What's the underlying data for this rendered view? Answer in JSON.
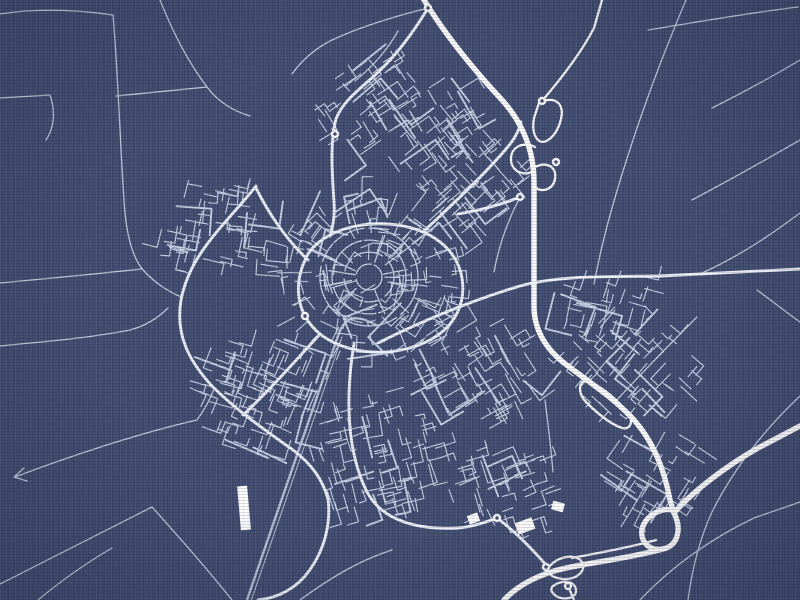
{
  "poster": {
    "width": 800,
    "height": 600,
    "seed": 12,
    "background_color": "#414c70",
    "road_thin_color": "#d3dcee",
    "road_medium_color": "#eef2fa",
    "road_major_color": "#ffffff",
    "railway_color": "#c6cfe2",
    "motorways": [
      "M 424,0 C 446,36 474,70 502,100 C 522,122 534,150 534,182 L 534,306 C 534,330 546,350 568,366 C 592,384 616,400 634,420 C 652,440 664,468 670,500 L 674,513",
      "M 674,513 C 692,492 726,466 758,448 L 800,426",
      "M 674,513 C 682,529 678,546 663,549 C 648,552 638,539 643,526 C 648,514 662,508 672,510",
      "M 663,549 C 630,558 594,562 566,568 C 538,574 517,586 504,600"
    ],
    "ramps": [
      "M 539,103 C 554,95 565,103 561,119 C 557,136 545,146 538,140 C 532,134 532,122 536,112 Z",
      "M 535,147 C 523,141 511,147 511,159 C 511,171 523,177 534,171",
      "M 535,167 C 547,161 557,167 555,179 C 553,190 541,193 535,187",
      "M 542,101 C 560,80 580,55 594,28 L 602,0",
      "M 586,380 C 604,388 618,400 628,414 C 634,422 630,430 622,428 C 610,424 596,412 586,402 C 578,394 578,382 586,380 Z",
      "M 549,567 C 558,556 576,553 582,562 C 587,571 576,580 563,579 C 553,578 545,573 549,567 Z",
      "M 553,586 C 563,579 575,581 576,590 C 577,598 564,601 556,596 C 551,592 550,589 553,586 Z",
      "M 568,586 L 574,600",
      "M 656,540 C 628,548 598,553 572,558"
    ],
    "major_roads": [
      "M 308,254 C 292,284 296,314 320,334 C 348,356 396,358 430,340 C 456,326 466,302 462,278 C 458,254 440,238 418,230 C 382,217 328,224 308,254 Z",
      "M 256,186 C 228,222 190,252 181,300 C 175,336 190,362 212,386 C 238,412 268,432 293,450 C 313,465 323,481 328,499",
      "M 328,499 C 331,523 325,549 309,571 C 297,588 278,598 258,600",
      "M 428,8 C 410,38 392,60 373,77 C 356,92 342,103 336,119 C 330,141 332,172 334,202 C 335,217 333,227 330,236",
      "M 424,231 C 452,205 482,177 506,149 C 514,140 519,131 521,122",
      "M 378,343 C 420,322 470,301 520,286 C 560,275 610,277 660,276 L 800,269",
      "M 354,344 C 345,398 347,452 367,492 C 383,522 420,530 458,528 C 472,527 486,522 497,518",
      "M 497,518 C 516,532 533,550 547,566",
      "M 320,334 C 298,358 268,392 243,415",
      "M 308,260 C 288,241 270,216 256,188",
      "M 520,197 C 498,206 476,211 458,214"
    ],
    "railway": [
      "M 247,600 L 338,336 C 346,312 360,316 378,326",
      "M 251,601 L 342,337"
    ],
    "rural_roads": [
      "M 0,14 C 38,8 78,10 113,15",
      "M 113,15 C 118,72 120,142 124,200 C 126,236 133,259 144,271 C 156,284 168,291 181,297",
      "M 0,98 C 18,97 34,96 50,95 C 56,112 54,128 46,140",
      "M 160,0 C 172,30 188,62 207,87 C 219,103 234,111 250,116",
      "M 116,96 C 148,93 178,90 207,87",
      "M 0,283 C 45,279 95,274 142,269",
      "M 0,346 C 40,342 90,338 130,330 C 145,326 158,318 168,308",
      "M 15,477 C 70,456 140,433 197,420 C 205,409 211,397 214,389",
      "M 24,468 L 14,477 L 27,481",
      "M 0,584 C 52,558 104,531 152,507",
      "M 38,600 C 62,580 88,562 112,548",
      "M 152,507 C 180,538 208,570 232,600",
      "M 300,600 C 330,578 360,560 392,550",
      "M 686,0 C 664,52 642,110 624,168 C 610,212 600,252 594,284",
      "M 648,30 C 698,22 748,13 798,7",
      "M 800,60 C 770,78 740,94 712,108",
      "M 800,140 C 762,162 726,182 692,200",
      "M 700,274 C 740,256 772,234 800,213",
      "M 757,290 C 772,301 786,312 800,322",
      "M 697,317 C 668,346 640,375 614,403",
      "M 800,396 C 764,430 734,468 712,512 C 700,538 692,570 688,600",
      "M 640,600 C 672,566 712,538 754,518 L 800,502",
      "M 545,400 C 548,424 551,448 553,472",
      "M 520,197 C 506,224 498,250 494,272",
      "M 428,8 C 396,16 362,26 332,40 C 316,48 302,60 292,74",
      "M 398,31 C 386,52 372,67 355,81"
    ],
    "junctions": [
      [
        428,
        8
      ],
      [
        542,
        101
      ],
      [
        556,
        162
      ],
      [
        520,
        197
      ],
      [
        546,
        567
      ],
      [
        568,
        586
      ],
      [
        497,
        518
      ],
      [
        305,
        316
      ],
      [
        335,
        134
      ]
    ],
    "ring_system": {
      "cx": 369,
      "cy": 277,
      "radii": [
        13,
        25,
        37,
        49
      ],
      "spokes": 11
    },
    "clusters": [
      {
        "cx": 369,
        "cy": 277,
        "rx": 92,
        "ry": 82,
        "n": 150,
        "mode": "radial",
        "angle": 0
      },
      {
        "cx": 392,
        "cy": 112,
        "rx": 80,
        "ry": 52,
        "n": 90,
        "mode": "grid",
        "angle": -35
      },
      {
        "cx": 472,
        "cy": 182,
        "rx": 58,
        "ry": 48,
        "n": 55,
        "mode": "grid",
        "angle": -40
      },
      {
        "cx": 208,
        "cy": 222,
        "rx": 52,
        "ry": 48,
        "n": 50,
        "mode": "grid",
        "angle": 10
      },
      {
        "cx": 255,
        "cy": 390,
        "rx": 72,
        "ry": 62,
        "n": 85,
        "mode": "grid",
        "angle": 20
      },
      {
        "cx": 372,
        "cy": 452,
        "rx": 68,
        "ry": 62,
        "n": 80,
        "mode": "grid",
        "angle": -15
      },
      {
        "cx": 470,
        "cy": 368,
        "rx": 58,
        "ry": 55,
        "n": 65,
        "mode": "grid",
        "angle": -30
      },
      {
        "cx": 628,
        "cy": 356,
        "rx": 72,
        "ry": 52,
        "n": 60,
        "mode": "grid",
        "angle": 42
      },
      {
        "cx": 652,
        "cy": 470,
        "rx": 58,
        "ry": 42,
        "n": 42,
        "mode": "grid",
        "angle": 30
      },
      {
        "cx": 502,
        "cy": 488,
        "rx": 58,
        "ry": 46,
        "n": 48,
        "mode": "grid",
        "angle": -20
      },
      {
        "cx": 598,
        "cy": 296,
        "rx": 55,
        "ry": 32,
        "n": 30,
        "mode": "grid",
        "angle": 15
      }
    ],
    "landmarks": [
      [
        239,
        486,
        10,
        44,
        -5
      ],
      [
        516,
        520,
        18,
        12,
        -20
      ],
      [
        468,
        514,
        11,
        9,
        -20
      ],
      [
        552,
        502,
        12,
        9,
        15
      ]
    ]
  }
}
